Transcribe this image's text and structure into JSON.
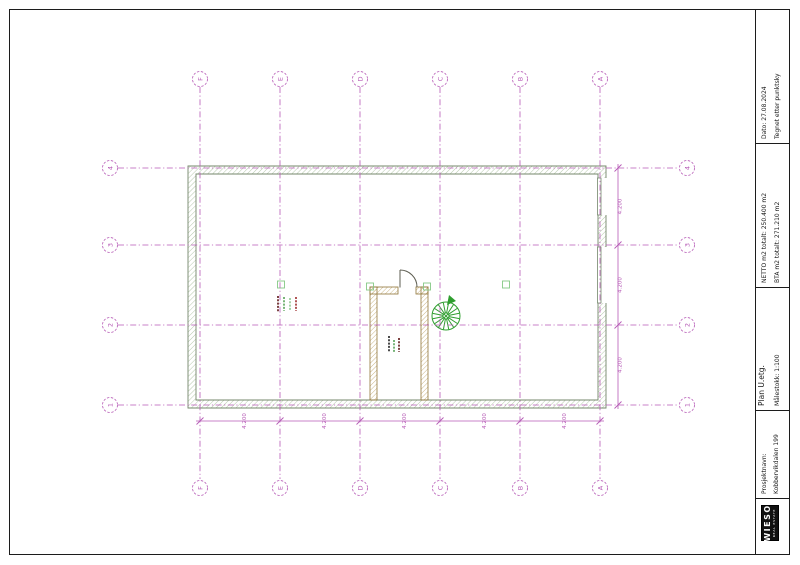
{
  "title_block": {
    "date": "Dato: 27.08.2024",
    "note": "Tegnet etter punktsky",
    "netto": "NETTO m2 totalt: 250.400 m2",
    "bta": "BTA m2 totalt: 271.210 m2",
    "plan_title": "Plan U.etg.",
    "scale": "Målestokk: 1:100",
    "project_label": "Prosjektnavn:",
    "project_name": "Kobbervikdalen 199",
    "logo": {
      "name": "WIESO",
      "sub": "REAL ESTATE"
    }
  },
  "grid": {
    "columns": [
      "F",
      "E",
      "D",
      "C",
      "B",
      "A"
    ],
    "rows": [
      "4",
      "3",
      "2",
      "1"
    ]
  },
  "dimensions": {
    "bottom": [
      "4.200",
      "4.200",
      "4.200",
      "4.200",
      "4.200"
    ],
    "right": [
      "4.200",
      "4.200",
      "4.200"
    ]
  },
  "colors": {
    "grid": "#b65ab6",
    "wall_edge": "#74876b",
    "wall_hatch": "#a3bb97",
    "stair_wall_edge": "#8f7437",
    "stair_wall_hatch": "#bfa66b",
    "stair_green": "#2f9e2f",
    "square_green": "#86c986",
    "tag_maroon": "#7d4343",
    "tag_green": "#79b579",
    "tag_green_light": "#a5d2a5",
    "tag_red": "#b05555",
    "tag_dark": "#4a4a4a",
    "line_black": "#1c1c1c"
  }
}
